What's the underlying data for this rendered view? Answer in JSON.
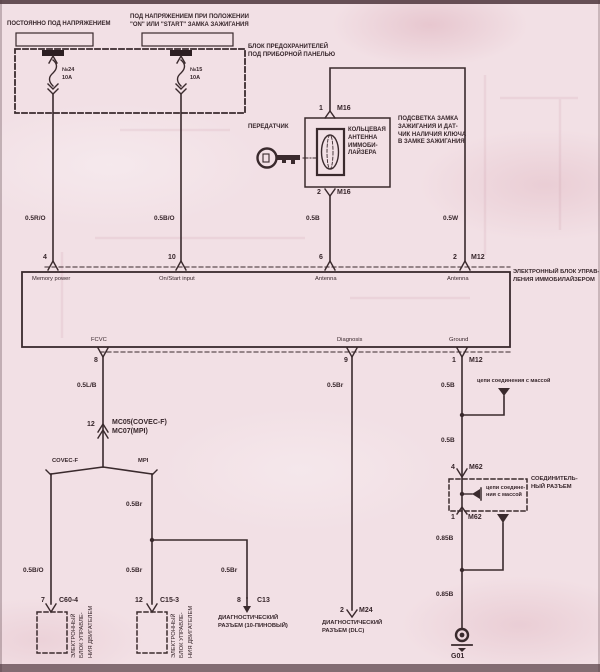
{
  "colors": {
    "background": "#f2e0e5",
    "line": "#3a2a2d",
    "text": "#37262b"
  },
  "top_labels": {
    "always": "ПОСТОЯННО ПОД НАПРЯЖЕНИЕМ",
    "ign1": "ПОД НАПРЯЖЕНИЕМ ПРИ ПОЛОЖЕНИИ",
    "ign2": "\"ON\" ИЛИ \"START\" ЗАМКА ЗАЖИГАНИЯ"
  },
  "fuse_block": {
    "title1": "БЛОК ПРЕДОХРАНИТЕЛЕЙ",
    "title2": "ПОД ПРИБОРНОЙ ПАНЕЛЬЮ",
    "fuse1_no": "№24",
    "fuse1_amp": "10A",
    "fuse2_no": "№15",
    "fuse2_amp": "10A"
  },
  "immo_antenna": {
    "transmitter": "ПЕРЕДАТЧИК",
    "coil1": "КОЛЬЦЕВАЯ",
    "coil2": "АНТЕННА",
    "coil3": "ИММОБИ-",
    "coil4": "ЛАЙЗЕРА",
    "pin_top_no": "1",
    "pin_top_conn": "M16",
    "pin_bot_no": "2",
    "pin_bot_conn": "M16",
    "note1": "ПОДСВЕТКА ЗАМКА",
    "note2": "ЗАЖИГАНИЯ И ДАТ-",
    "note3": "ЧИК НАЛИЧИЯ КЛЮЧА",
    "note4": "В ЗАМКЕ ЗАЖИГАНИЯ"
  },
  "immo_ecu": {
    "name1": "ЭЛЕКТРОННЫЙ БЛОК УПРАВ-",
    "name2": "ЛЕНИЯ ИММОБИЛАЙЗЕРОМ",
    "pins_top": [
      {
        "no": "4",
        "label": "Memory power"
      },
      {
        "no": "10",
        "label": "On/Start input"
      },
      {
        "no": "6",
        "label": "Antenna"
      },
      {
        "no": "2",
        "conn": "M12",
        "label": "Antenna"
      }
    ],
    "pins_bottom": [
      {
        "no": "8",
        "label": "FCVC"
      },
      {
        "no": "9",
        "label": "Diagnosis"
      },
      {
        "no": "1",
        "conn": "M12",
        "label": "Ground"
      }
    ]
  },
  "wires": {
    "memory": "0.5R/O",
    "onstart": "0.5B/O",
    "ant1": "0.5B",
    "ant2": "0.5W",
    "fcvc": "0.5L/B",
    "diag": "0.5Br",
    "gnd1": "0.5B",
    "gnd2": "0.5B",
    "gnd3": "0.85B",
    "gnd4": "0.85B",
    "mpi1": "0.5Br",
    "mpi2": "0.5Br",
    "mpi3": "0.5Br",
    "covec": "0.5B/O"
  },
  "engine_ecu": {
    "mc_no": "12",
    "mc1": "MC05(COVEC-F)",
    "mc2": "MC07(MPI)",
    "covec": "COVEC-F",
    "mpi": "MPI",
    "c60_no": "7",
    "c60": "C60-4",
    "c15_no": "12",
    "c15": "C15-3",
    "ecu1": "ЭЛЕКТРОННЫЙ",
    "ecu2": "БЛОК УПРАВЛЕ-",
    "ecu3": "НИЯ ДВИГАТЕЛЕМ"
  },
  "diagnostics": {
    "c13_no": "8",
    "c13": "C13",
    "c13_l1": "ДИАГНОСТИЧЕСКИЙ",
    "c13_l2": "РАЗЪЕМ (10-ПИНОВЫЙ)",
    "m24_no": "2",
    "m24": "M24",
    "m24_l1": "ДИАГНОСТИЧЕСКИЙ",
    "m24_l2": "РАЗЪЕМ (DLC)"
  },
  "ground": {
    "mass_note": "цепи соединения с массой",
    "m62_top_no": "4",
    "m62_top": "M62",
    "joint1": "цепи соедине-",
    "joint2": "ния с массой",
    "conn1": "СОЕДИНИТЕЛЬ-",
    "conn2": "НЫЙ РАЗЪЕМ",
    "m62_bot_no": "1",
    "m62_bot": "M62",
    "g01": "G01"
  }
}
